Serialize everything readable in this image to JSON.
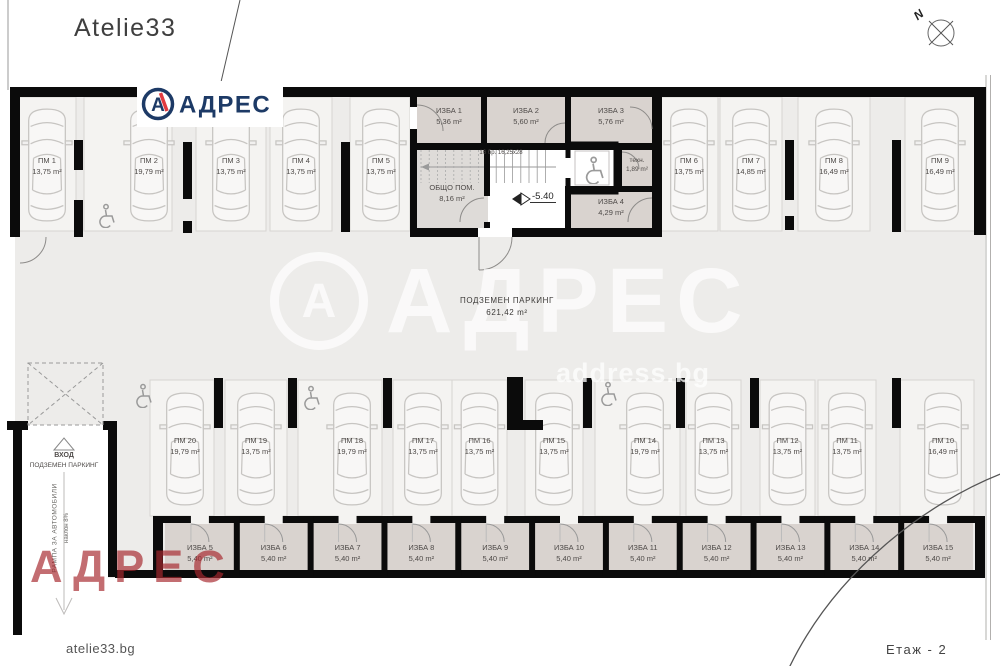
{
  "meta": {
    "brand": "Atelie33",
    "site_label": "atelie33.bg",
    "floor_label": "Етаж - 2",
    "compass_label": "N"
  },
  "logo": {
    "letter": "А",
    "brand": "АДРЕС"
  },
  "watermark": {
    "letter": "А",
    "brand": "АДРЕС",
    "site": "address.bg"
  },
  "watermark_red": {
    "brand": "АДРЕС"
  },
  "hall": {
    "name": "ПОДЗЕМЕН ПАРКИНГ",
    "area": "621,42 m²"
  },
  "level_marker": {
    "value": "-5.40"
  },
  "stairs": {
    "note": "16 бр. 16,25х28"
  },
  "entrance": {
    "line1": "ВХОД",
    "line2": "ПОДЗЕМЕН ПАРКИНГ",
    "ramp": "РАМПА ЗА АВТОМОБИЛИ",
    "slope": "наклон 8%"
  },
  "rooms": {
    "top": [
      {
        "name": "ИЗБА 1",
        "area": "5,36 m²"
      },
      {
        "name": "ИЗБА 2",
        "area": "5,60 m²"
      },
      {
        "name": "ИЗБА 3",
        "area": "5,76 m²"
      }
    ],
    "common": {
      "name": "ОБЩО ПОМ.",
      "area": "8,16 m²"
    },
    "tech": {
      "name": "техн.",
      "area": "1,89 m²"
    },
    "izba4": {
      "name": "ИЗБА 4",
      "area": "4,29 m²"
    },
    "bottom": [
      {
        "name": "ИЗБА 5",
        "area": "5,40 m²"
      },
      {
        "name": "ИЗБА 6",
        "area": "5,40 m²"
      },
      {
        "name": "ИЗБА 7",
        "area": "5,40 m²"
      },
      {
        "name": "ИЗБА 8",
        "area": "5,40 m²"
      },
      {
        "name": "ИЗБА 9",
        "area": "5,40 m²"
      },
      {
        "name": "ИЗБА 10",
        "area": "5,40 m²"
      },
      {
        "name": "ИЗБА 11",
        "area": "5,40 m²"
      },
      {
        "name": "ИЗБА 12",
        "area": "5,40 m²"
      },
      {
        "name": "ИЗБА 13",
        "area": "5,40 m²"
      },
      {
        "name": "ИЗБА 14",
        "area": "5,40 m²"
      },
      {
        "name": "ИЗБА 15",
        "area": "5,40 m²"
      }
    ]
  },
  "parking": {
    "top_row": [
      {
        "name": "ПМ 1",
        "area": "13,75 m²"
      },
      {
        "name": "ПМ 2",
        "area": "19,79 m²"
      },
      {
        "name": "ПМ 3",
        "area": "13,75 m²"
      },
      {
        "name": "ПМ 4",
        "area": "13,75 m²"
      },
      {
        "name": "ПМ 5",
        "area": "13,75 m²"
      },
      {
        "name": "ПМ 6",
        "area": "13,75 m²"
      },
      {
        "name": "ПМ 7",
        "area": "14,85 m²"
      },
      {
        "name": "ПМ 8",
        "area": "16,49 m²"
      },
      {
        "name": "ПМ 9",
        "area": "16,49 m²"
      }
    ],
    "bottom_row": [
      {
        "name": "ПМ 20",
        "area": "19,79 m²"
      },
      {
        "name": "ПМ 19",
        "area": "13,75 m²"
      },
      {
        "name": "ПМ 18",
        "area": "19,79 m²"
      },
      {
        "name": "ПМ 17",
        "area": "13,75 m²"
      },
      {
        "name": "ПМ 16",
        "area": "13,75 m²"
      },
      {
        "name": "ПМ 15",
        "area": "13,75 m²"
      },
      {
        "name": "ПМ 14",
        "area": "19,79 m²"
      },
      {
        "name": "ПМ 13",
        "area": "13,75 m²"
      },
      {
        "name": "ПМ 12",
        "area": "13,75 m²"
      },
      {
        "name": "ПМ 11",
        "area": "13,75 m²"
      },
      {
        "name": "ПМ 10",
        "area": "16,49 m²"
      }
    ]
  }
}
